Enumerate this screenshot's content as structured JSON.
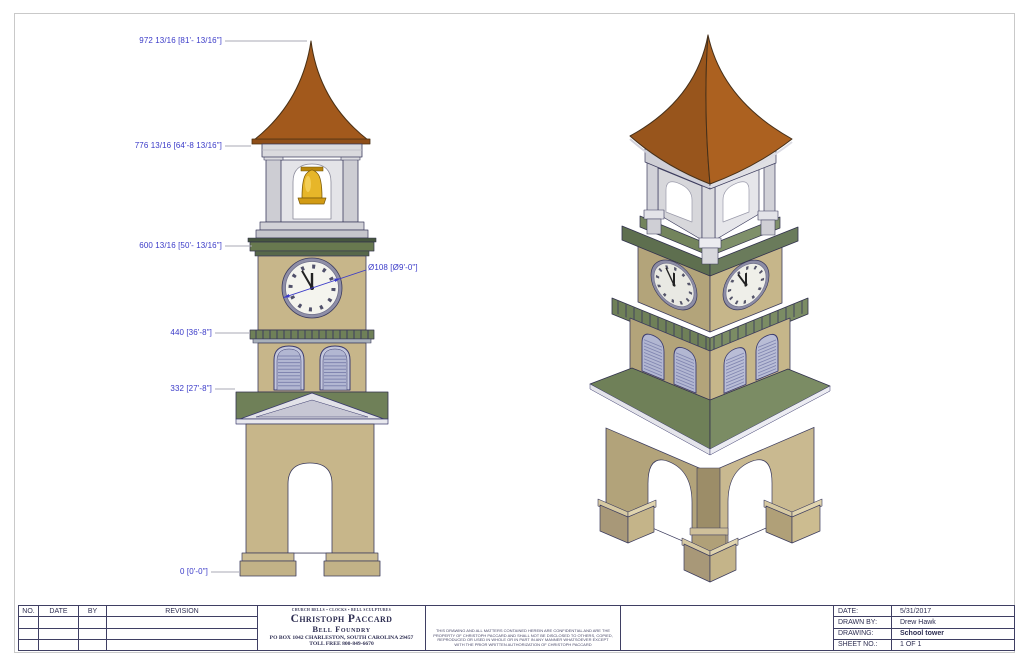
{
  "dimensions": {
    "elevation_labels": [
      {
        "text": "972 13/16 [81'- 13/16\"]"
      },
      {
        "text": "776 13/16 [64'-8 13/16\"]"
      },
      {
        "text": "600 13/16 [50'- 13/16\"]"
      },
      {
        "text": "440 [36'-8\"]"
      },
      {
        "text": "332 [27'-8\"]"
      },
      {
        "text": "0 [0'-0\"]"
      }
    ],
    "clock_diameter_label": "Ø108 [Ø9'-0\"]"
  },
  "clock": {
    "time_shown": "11:55",
    "numeral_style": "roman"
  },
  "title_block": {
    "revision_table": {
      "headers": [
        "NO.",
        "DATE",
        "BY",
        "REVISION"
      ],
      "empty_row_count": 3
    },
    "company": {
      "tagline": "CHURCH BELLS • CLOCKS • BELL SCULPTURES",
      "name": "Christoph Paccard",
      "name2": "Bell Foundry",
      "address": "PO BOX 1042 CHARLESTON, SOUTH CAROLINA 29457",
      "phone": "TOLL FREE 800-849-6670"
    },
    "disclaimer": "THIS DRAWING AND ALL MATTERS CONTAINED HEREIN ARE CONFIDENTIAL AND ARE THE PROPERTY OF CHRISTOPH PACCARD AND SHALL NOT BE DISCLOSED TO OTHERS, COPIED, REPRODUCED OR USED IN WHOLE OR IN PART IN ANY MANNER WHATSOEVER EXCEPT WITH THE PRIOR WRITTEN AUTHORIZATION OF CHRISTOPH PACCARD",
    "info": {
      "rows": [
        {
          "label": "DATE:",
          "value": "5/31/2017"
        },
        {
          "label": "DRAWN BY:",
          "value": "Drew Hawk"
        },
        {
          "label": "DRAWING:",
          "value": "School tower"
        },
        {
          "label": "SHEET NO.:",
          "value": "1 OF 1"
        }
      ]
    }
  },
  "palette": {
    "roof_copper": "#a2591c",
    "wall_tan": "#c7b68a",
    "cornice_green": "#6f8058",
    "belfry_gray": "#d9d9dc",
    "louver_blue": "#b2b7d2",
    "clock_face": "#f4f4ee",
    "bell_gold": "#e7b629",
    "dimension_blue": "#3a3ac8",
    "outline_navy": "#3c3c5e"
  }
}
